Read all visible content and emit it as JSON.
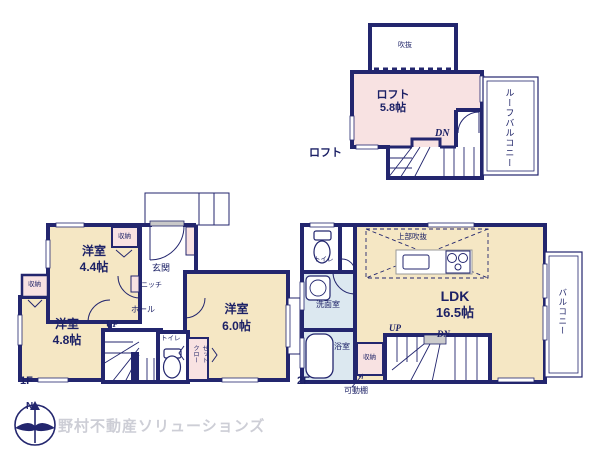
{
  "palette": {
    "wall": "#23266e",
    "room_cream": "#f5e7c4",
    "room_pink": "#f8e2e2",
    "room_blue": "#dce8f0",
    "label_navy": "#1c2166",
    "threshold_gray": "#c9c9c9",
    "logo_text_gray": "#cdced6"
  },
  "loft": {
    "void": "吹抜",
    "name": "ロフト",
    "size": "5.8帖",
    "dn": "DN",
    "floor_tag": "ロフト",
    "roof_balcony": "ルーフバルコニー"
  },
  "f1": {
    "tag": "1F",
    "room_a": {
      "name": "洋室",
      "size": "4.4帖"
    },
    "room_b": {
      "name": "洋室",
      "size": "4.8帖"
    },
    "room_c": {
      "name": "洋室",
      "size": "6.0帖"
    },
    "storage_a": "収納",
    "storage_b": "収納",
    "entrance": "玄関",
    "niche": "ニッチ",
    "hall": "ホール",
    "up": "UP",
    "toilet": "トイレ",
    "closet": "クローゼット"
  },
  "f2": {
    "tag": "2F",
    "toilet": "トイレ",
    "washroom": "洗面室",
    "bathroom": "浴室",
    "ldk": {
      "name": "LDK",
      "size": "16.5帖"
    },
    "upper_void": "上部吹抜",
    "up": "UP",
    "dn": "DN",
    "storage": "収納",
    "movable_shelf": "可動棚",
    "balcony": "バルコニー"
  },
  "footer": {
    "company": "野村不動産ソリューションズ",
    "compass_n": "N"
  }
}
